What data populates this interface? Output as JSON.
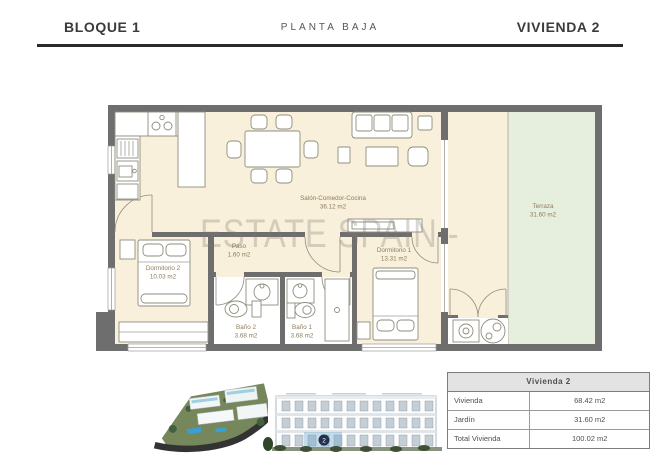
{
  "header": {
    "block": "BLOQUE 1",
    "floor": "PLANTA BAJA",
    "unit": "VIVIENDA 2"
  },
  "watermark": "ESTATE SPAIN -",
  "rooms": {
    "salon": {
      "name": "Salón-Comedor-Cocina",
      "area": "36.12 m2"
    },
    "paso": {
      "name": "Paso",
      "area": "1.60 m2"
    },
    "dormitorio2": {
      "name": "Dormitorio 2",
      "area": "10.03 m2"
    },
    "dormitorio1": {
      "name": "Dormitorio 1",
      "area": "13.31 m2"
    },
    "bano2": {
      "name": "Baño 2",
      "area": "3.68 m2"
    },
    "bano1": {
      "name": "Baño 1",
      "area": "3.68 m2"
    },
    "terraza": {
      "name": "Terraza",
      "area": "31.60 m2"
    }
  },
  "elevation": {
    "marker": "2"
  },
  "table": {
    "title": "Vivienda 2",
    "rows": [
      {
        "label": "Vivienda",
        "value": "68.42 m2"
      },
      {
        "label": "Jardín",
        "value": "31.60 m2"
      },
      {
        "label": "Total Vivienda",
        "value": "100.02 m2"
      }
    ]
  },
  "colors": {
    "floor": "#f8f0da",
    "garden": "#e6eedd",
    "wall": "#6e6e6e",
    "marker": "#23304f",
    "header_text": "#3b3b3b"
  }
}
